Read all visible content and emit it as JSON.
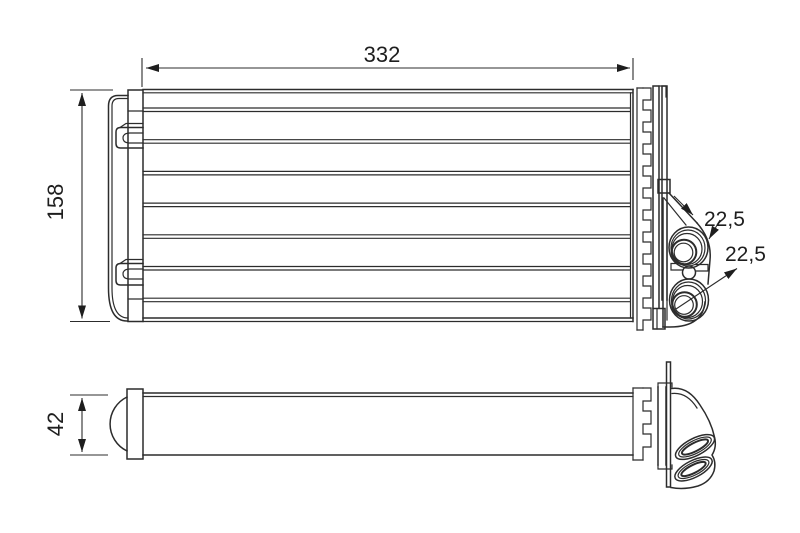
{
  "drawing": {
    "kind": "technical-part-drawing",
    "part": "heater-core-heat-exchanger",
    "colors": {
      "line": "#2c2c2c",
      "background": "#ffffff"
    },
    "dimensions": {
      "width": "332",
      "height": "158",
      "depth": "42",
      "pipe_diameter_top": "22,5",
      "pipe_diameter_bottom": "22,5"
    }
  }
}
